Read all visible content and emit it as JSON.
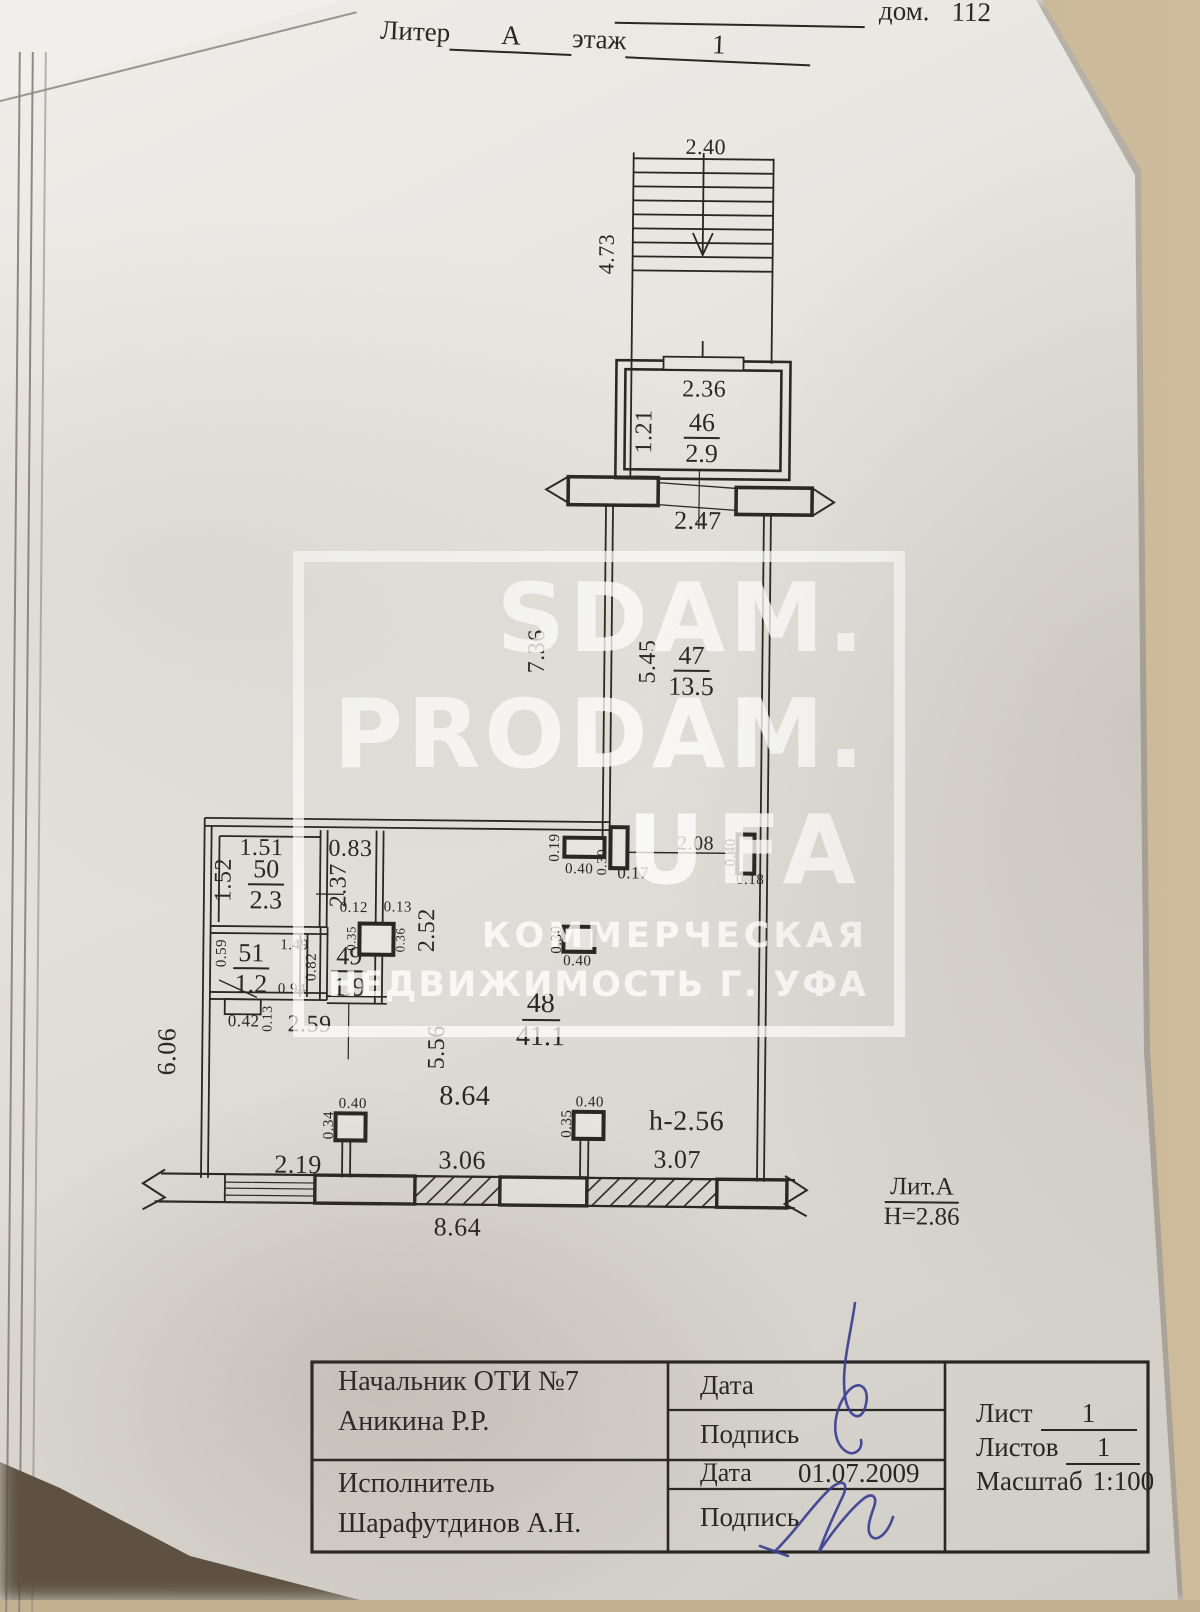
{
  "header": {
    "house_label": "дом.",
    "house_number": "112",
    "liter_label": "Литер",
    "liter_value": "А",
    "floor_label": "этаж",
    "floor_value": "1"
  },
  "watermark": {
    "line1": "SDAM.",
    "line2": "PRODAM.",
    "line3": "UFA",
    "sub1": "КОММЕРЧЕСКАЯ",
    "sub2": "НЕДВИЖИМОСТЬ Г. УФА"
  },
  "plan": {
    "rooms": {
      "r46": {
        "number": "46",
        "area": "2.9"
      },
      "r47": {
        "number": "47",
        "area": "13.5"
      },
      "r48": {
        "number": "48",
        "area": "41.1"
      },
      "r49": {
        "number": "49",
        "area": "1.9"
      },
      "r50": {
        "number": "50",
        "area": "2.3"
      },
      "r51": {
        "number": "51",
        "area": "1.2"
      }
    },
    "dims": {
      "stair_width": "2.40",
      "stair_length": "4.73",
      "r46_width": "2.36",
      "r46_depth": "1.21",
      "entrance_width": "2.47",
      "r47_left": "7.36",
      "r47_inner": "5.45",
      "opening_width": "2.08",
      "pier1_depth": "0.19",
      "pier1_width": "0.40",
      "col1_depth": "0.30",
      "col1_width": "0.17",
      "pier2_depth": "0.40",
      "pier2_width": "0.18",
      "r50_width": "1.51",
      "r50_depth": "1.52",
      "corridor_width": "0.83",
      "corridor_depth": "2.37",
      "col2_left": "0.12",
      "col2_right": "0.13",
      "col2_side_left": "0.35",
      "col2_side_right": "0.36",
      "wall_2_52": "2.52",
      "r51_side": "0.59",
      "r51_wall1": "1.49",
      "r51_wall2": "0.82",
      "r51_wall3": "0.94",
      "niche_width": "0.42",
      "niche_depth": "0.13",
      "wall_2_59": "2.59",
      "left_wall": "6.06",
      "wall_5_56": "5.56",
      "midcol_depth": "0.30",
      "midcol_width": "0.40",
      "hall_width": "8.64",
      "ceiling_height": "h-2.56",
      "colA_width": "0.40",
      "colA_depth": "0.34",
      "colB_width": "0.40",
      "colB_depth": "0.35",
      "bottom_seg1": "2.19",
      "bottom_seg2": "3.06",
      "bottom_seg3": "3.07",
      "bottom_total": "8.64"
    },
    "legend": {
      "liter": "Лит.А",
      "height": "Н=2.86"
    }
  },
  "titleblock": {
    "chief_role": "Начальник ОТИ №7",
    "chief_name": "Аникина Р.Р.",
    "executor_role": "Исполнитель",
    "executor_name": "Шарафутдинов А.Н.",
    "date_label_1": "Дата",
    "sign_label_1": "Подпись",
    "date_label_2": "Дата",
    "date_value": "01.07.2009",
    "sign_label_2": "Подпись",
    "sheet_label": "Лист",
    "sheet_value": "1",
    "sheets_label": "Листов",
    "sheets_value": "1",
    "scale_label": "Масштаб",
    "scale_value": "1:100"
  }
}
